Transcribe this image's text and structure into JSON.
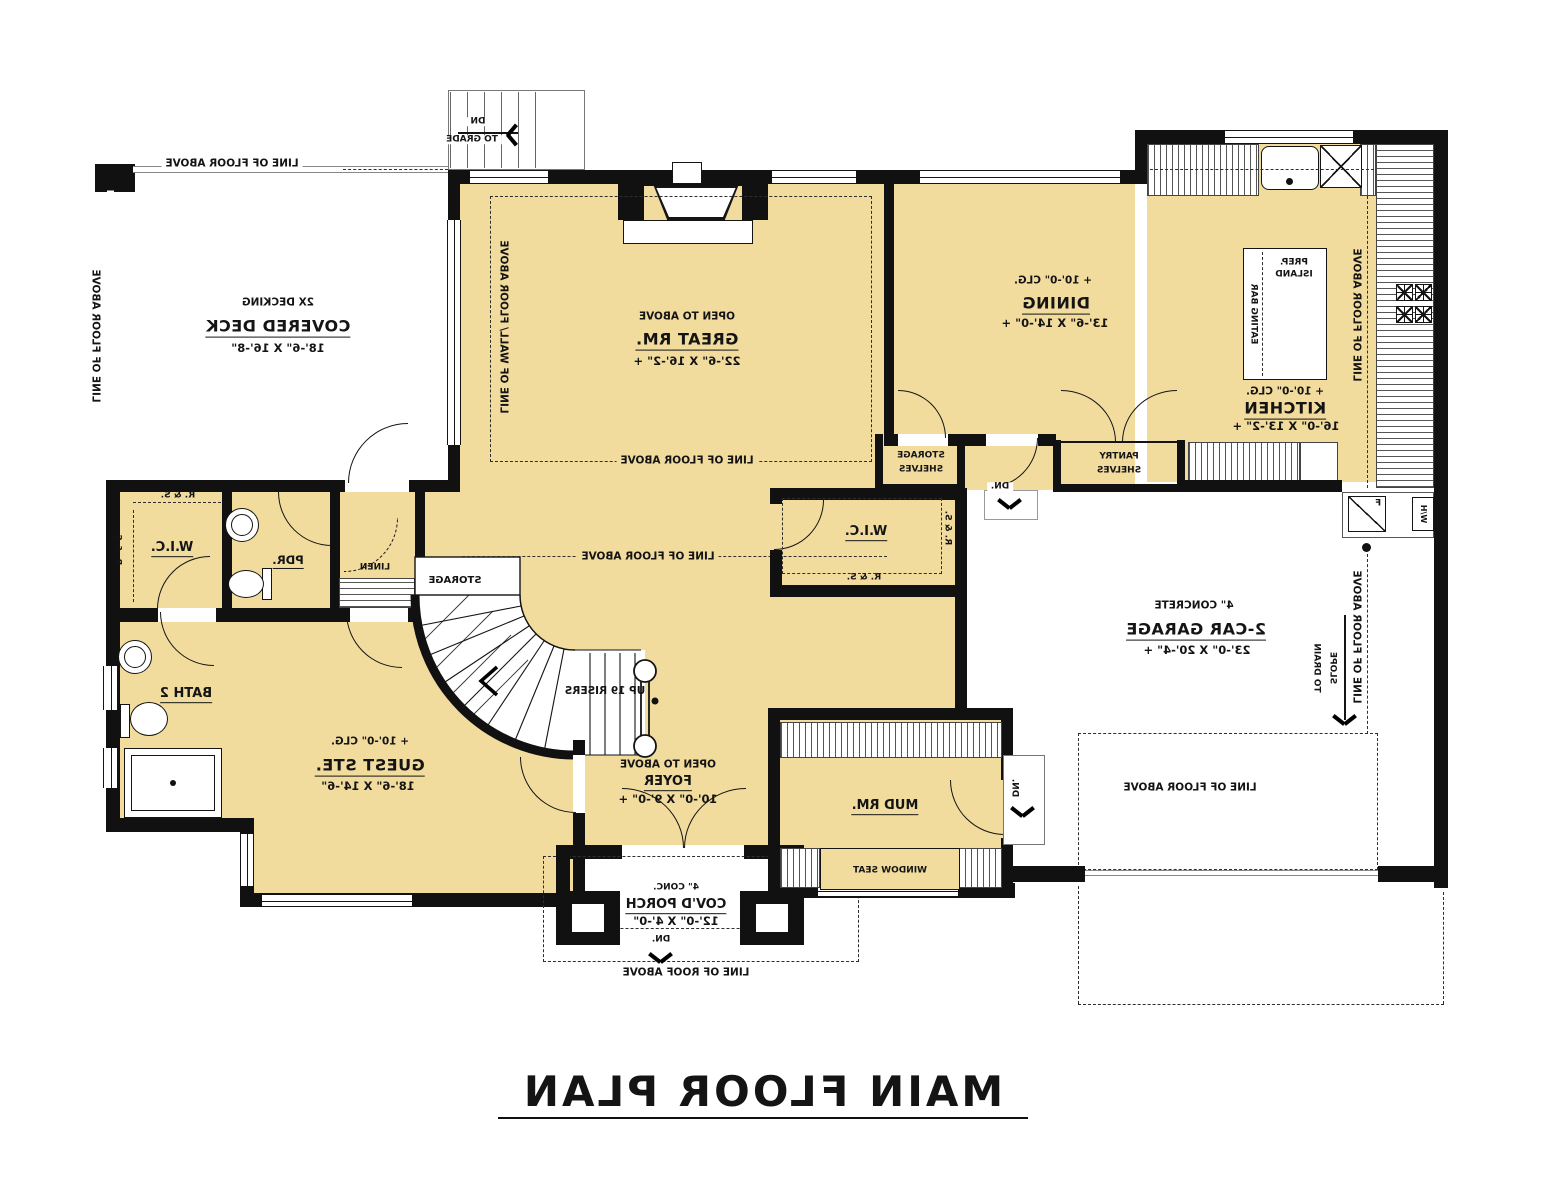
{
  "colors": {
    "floor": "#F1DC9E",
    "wall": "#111111",
    "paper": "#FFFFFF"
  },
  "title": "MAIN FLOOR PLAN",
  "rooms": {
    "covered_deck": {
      "note": "2X DECKING",
      "name": "COVERED DECK",
      "dim": "18'-6\" X 16'-8\""
    },
    "great_room": {
      "note": "OPEN TO ABOVE",
      "name": "GREAT RM.",
      "dim": "22'-6\" X 16'-2\" +"
    },
    "dining": {
      "ceiling": "+ 10'-0\" CLG.",
      "name": "DINING",
      "dim": "13'-6\" X 14'-0\" +"
    },
    "kitchen": {
      "ceiling": "+ 10'-0\" CLG.",
      "name": "KITCHEN",
      "dim": "16'-0\" X 13'-2\" +"
    },
    "guest_suite": {
      "ceiling": "+ 10'-0\" CLG.",
      "name": "GUEST STE.",
      "dim": "18'-6\" X 14'-6\""
    },
    "foyer": {
      "note": "OPEN TO ABOVE",
      "name": "FOYER",
      "dim": "10'-0\" X 9'-0\" +"
    },
    "porch": {
      "note": "4\" CONC.",
      "name": "COV'D PORCH",
      "dim": "12'-0\" X 4'-0\""
    },
    "garage": {
      "note": "4\" CONCRETE",
      "name": "2-CAR GARAGE",
      "dim": "23'-0\" X 20'-4\" +"
    },
    "mud_room": {
      "name": "MUD RM."
    },
    "bath_2": {
      "name": "BATH 2"
    },
    "powder": {
      "name": "PDR."
    },
    "wic_left": {
      "name": "W.I.C."
    },
    "wic_right": {
      "name": "W.I.C."
    },
    "linen": {
      "name": "LINEN"
    },
    "pantry": {
      "name": "PANTRY",
      "sub": "SHELVES"
    },
    "storage_closet": {
      "name": "STORAGE",
      "sub": "SHELVES"
    },
    "stair_storage": {
      "name": "STORAGE"
    }
  },
  "annotations": {
    "line_floor_above": "LINE OF FLOOR ABOVE",
    "line_wall_floor_above": "LINE OF WALL/ FLOOR ABOVE",
    "line_roof_above": "LINE OF ROOF ABOVE",
    "rod_and_shelf": "R. & S.",
    "up_risers": "UP 19 RISERS",
    "dn": "DN",
    "to_grade": "TO GRADE",
    "dn_dot": "DN.",
    "slope": "SLOPE",
    "to_drain": "TO DRAIN",
    "window_seat": "WINDOW SEAT",
    "prep": "PREP.",
    "island": "ISLAND",
    "eating_bar": "EATING BAR",
    "furnace": "F",
    "water_heater": "W/H"
  }
}
